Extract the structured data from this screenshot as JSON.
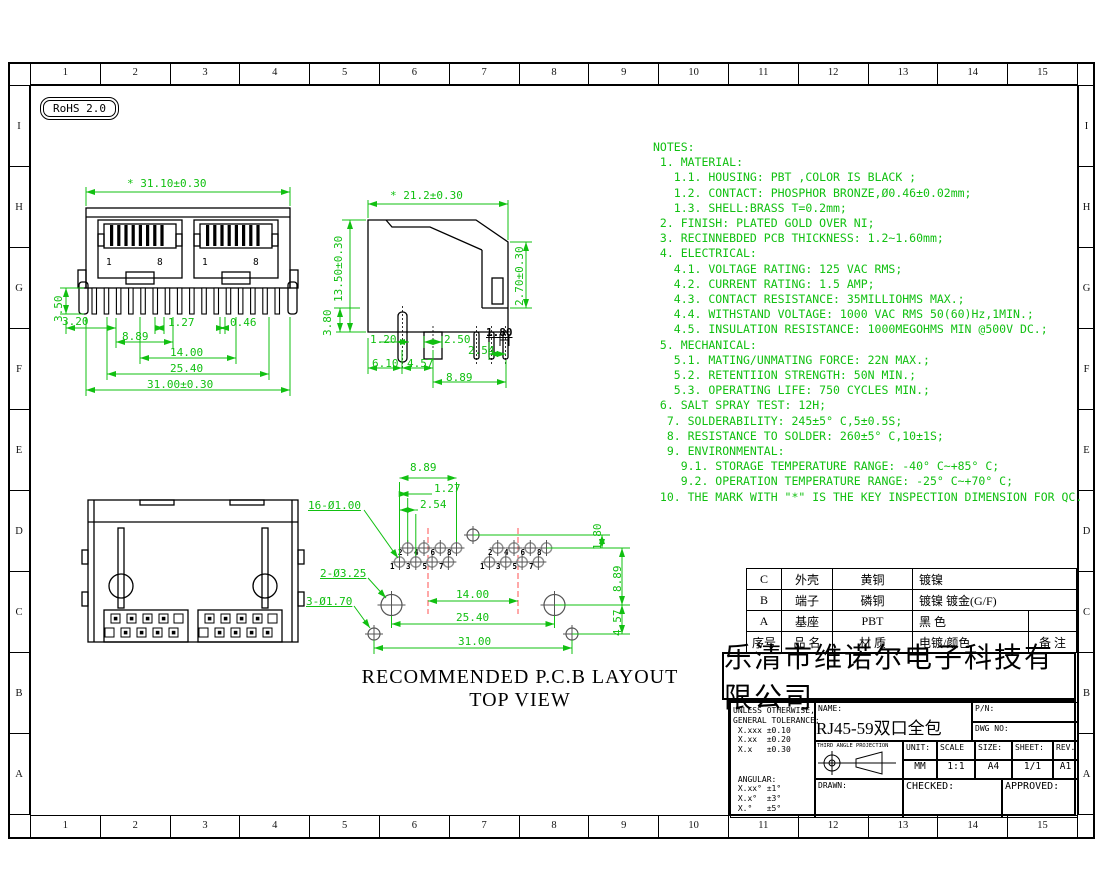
{
  "drawing": {
    "rohs_badge": "RoHS 2.0",
    "caption_line1": "RECOMMENDED P.C.B LAYOUT",
    "caption_line2": "TOP VIEW"
  },
  "sheet": {
    "columns": [
      "1",
      "2",
      "3",
      "4",
      "5",
      "6",
      "7",
      "8",
      "9",
      "10",
      "11",
      "12",
      "13",
      "14",
      "15"
    ],
    "rows": [
      "I",
      "H",
      "G",
      "F",
      "E",
      "D",
      "C",
      "B",
      "A"
    ]
  },
  "front_view": {
    "dims": {
      "top": "* 31.10±0.30",
      "v350": "3.50",
      "h320": "3.20",
      "d127": "1.27",
      "d046": "0.46",
      "d889": "8.89",
      "d1400": "14.00",
      "d2540": "25.40",
      "bottom": "31.00±0.30",
      "pin1": "1",
      "pin8": "8"
    }
  },
  "side_view": {
    "dims": {
      "top": "* 21.2±0.30",
      "left": "13.50±0.30",
      "v380": "3.80",
      "right": "2.70±0.30",
      "d120": "1.20",
      "d250": "2.50",
      "d180": "1.80",
      "d254": "2.54",
      "d610": "6.10",
      "d457": "4.57",
      "d889": "8.89"
    }
  },
  "pcb_view": {
    "dims": {
      "d889_top": "8.89",
      "d127": "1.27",
      "d254": "2.54",
      "d1400": "14.00",
      "d2540": "25.40",
      "d3100": "31.00",
      "v180": "1.80",
      "v889": "8.89",
      "v457": "4.57"
    },
    "hole_labels": {
      "pins": "16-Ø1.00",
      "big": "2-Ø3.25",
      "small": "3-Ø1.70"
    },
    "pins": [
      "1",
      "2",
      "3",
      "4",
      "5",
      "6",
      "7",
      "8"
    ]
  },
  "notes": {
    "lines": [
      "NOTES:",
      " 1. MATERIAL:",
      "   1.1. HOUSING: PBT ,COLOR IS BLACK ;",
      "   1.2. CONTACT: PHOSPHOR BRONZE,Ø0.46±0.02mm;",
      "   1.3. SHELL:BRASS T=0.2mm;",
      " 2. FINISH: PLATED GOLD OVER NI;",
      " 3. RECINNEBDED PCB THICKNESS: 1.2~1.60mm;",
      " 4. ELECTRICAL:",
      "   4.1. VOLTAGE RATING: 125 VAC RMS;",
      "   4.2. CURRENT RATING: 1.5 AMP;",
      "   4.3. CONTACT RESISTANCE: 35MILLIOHMS MAX.;",
      "   4.4. WITHSTAND VOLTAGE: 1000 VAC RMS 50(60)Hz,1MIN.;",
      "   4.5. INSULATION RESISTANCE: 1000MEGOHMS MIN @500V DC.;",
      " 5. MECHANICAL:",
      "   5.1. MATING/UNMATING FORCE: 22N MAX.;",
      "   5.2. RETENTIION STRENGTH: 50N MIN.;",
      "   5.3. OPERATING LIFE: 750 CYCLES MIN.;",
      " 6. SALT SPRAY TEST: 12H;",
      "  7. SOLDERABILITY: 245±5° C,5±0.5S;",
      "  8. RESISTANCE TO SOLDER: 260±5° C,10±1S;",
      "  9. ENVIRONMENTAL:",
      "    9.1. STORAGE TEMPERATURE RANGE: -40° C~+85° C;",
      "    9.2. OPERATION TEMPERATURE RANGE: -25° C~+70° C;",
      " 10. THE MARK WITH \"*\" IS THE KEY INSPECTION DIMENSION FOR QC."
    ]
  },
  "materials_table": {
    "header": {
      "no": "序号",
      "name": "品 名",
      "material": "材 质",
      "plating": "电镀/颜色",
      "remark": "备 注"
    },
    "rows": [
      {
        "no": "C",
        "name": "外壳",
        "material": "黄铜",
        "plating": "镀镍",
        "remark": ""
      },
      {
        "no": "B",
        "name": "端子",
        "material": "磷铜",
        "plating": "镀镍 镀金(G/F)",
        "remark": ""
      },
      {
        "no": "A",
        "name": "基座",
        "material": "PBT",
        "plating": "黑 色",
        "remark": ""
      }
    ]
  },
  "company": "乐清市维诺尔电子科技有限公司",
  "title_block": {
    "tolerance_lines": [
      "UNLESS OTHERWISE,",
      "GENERAL TOLERANCE:",
      " X.xxx ±0.10",
      " X.xx  ±0.20",
      " X.x   ±0.30",
      "",
      "",
      " ANGULAR:",
      " X.xx° ±1°",
      " X.x°  ±3°",
      " X.°   ±5°"
    ],
    "name_label": "NAME:",
    "part_name": "RJ45-59双口全包",
    "pn_label": "P/N:",
    "dwg_label": "DWG NO:",
    "projection_label": "THIRD ANGLE PROJECTION",
    "unit_label": "UNIT:",
    "unit_value": "MM",
    "scale_label": "SCALE",
    "scale_value": "1:1",
    "size_label": "SIZE:",
    "size_value": "A4",
    "sheet_label": "SHEET:",
    "sheet_value": "1/1",
    "rev_label": "REV.",
    "rev_value": "A1",
    "drawn_label": "DRAWN:",
    "checked_label": "CHECKED:",
    "approved_label": "APPROVED:"
  },
  "colors": {
    "dimension_green": "#11c011",
    "centerline_red": "#ff5050",
    "line_black": "#000000"
  }
}
